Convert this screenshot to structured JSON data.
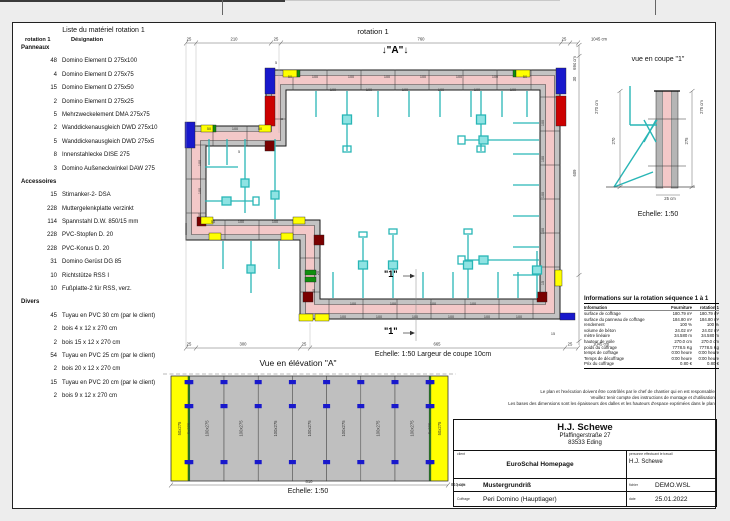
{
  "sheet": {
    "material_list": {
      "title": "Liste du matériel  rotation 1",
      "header": {
        "col1": "rotation 1",
        "col2": "Désignation"
      },
      "sections": [
        {
          "name": "Panneaux",
          "items": [
            {
              "qty": "48",
              "label": "Domino Element D 275x100"
            },
            {
              "qty": "4",
              "label": "Domino Element D 275x75"
            },
            {
              "qty": "15",
              "label": "Domino Element D 275x50"
            },
            {
              "qty": "2",
              "label": "Domino Element D 275x25"
            },
            {
              "qty": "5",
              "label": "Mehrzweckelement DMA 275x75"
            },
            {
              "qty": "2",
              "label": "Wanddickenausgleich DWD 275x10"
            },
            {
              "qty": "5",
              "label": "Wanddickenausgleich DWD 275x5"
            },
            {
              "qty": "8",
              "label": "Innenstahlecke DISE 275"
            },
            {
              "qty": "3",
              "label": "Domino Außeneckwinkel DAW 275"
            }
          ]
        },
        {
          "name": "Accessoires",
          "items": [
            {
              "qty": "15",
              "label": "Stirnanker-2- DSA"
            },
            {
              "qty": "228",
              "label": "Muttergelenkplatte verzinkt"
            },
            {
              "qty": "114",
              "label": "Spannstahl D.W. 850/15 mm"
            },
            {
              "qty": "228",
              "label": "PVC-Stopfen D. 20"
            },
            {
              "qty": "228",
              "label": "PVC-Konus D. 20"
            },
            {
              "qty": "31",
              "label": "Domino Gerüst DG 85"
            },
            {
              "qty": "10",
              "label": "Richtstütze RSS I"
            },
            {
              "qty": "10",
              "label": "Fußplatte-2 für RSS, verz."
            }
          ]
        },
        {
          "name": "Divers",
          "items": [
            {
              "qty": "45",
              "label": "Tuyau en PVC 30 cm (par le client)"
            },
            {
              "qty": "2",
              "label": "bois 4 x 12 x 270 cm"
            },
            {
              "qty": "2",
              "label": "bois 15 x 12 x 270 cm"
            },
            {
              "qty": "54",
              "label": "Tuyau en PVC 25 cm (par le client)"
            },
            {
              "qty": "2",
              "label": "bois 20 x 12 x 270 cm"
            },
            {
              "qty": "15",
              "label": "Tuyau en PVC 20 cm (par le client)"
            },
            {
              "qty": "2",
              "label": "bois 9 x 12 x 270 cm"
            }
          ]
        }
      ]
    },
    "plan": {
      "title": "rotation 1",
      "section_mark_a": "↓\"A\"↓",
      "section_mark_1": "\"1\"",
      "scale_note": "Echelle: 1:50   Largeur de coupe 10cm",
      "dims_top": [
        {
          "t": "25",
          "x": 176
        },
        {
          "t": "210",
          "x": 221
        },
        {
          "t": "25",
          "x": 263
        },
        {
          "t": "760",
          "x": 408
        },
        {
          "t": "25",
          "x": 551
        },
        {
          "t": "1045 cm",
          "x": 586
        }
      ],
      "dims_bottom": [
        {
          "t": "25",
          "x": 176
        },
        {
          "t": "300",
          "x": 230
        },
        {
          "t": "25",
          "x": 291
        },
        {
          "t": "665",
          "x": 424
        },
        {
          "t": "25",
          "x": 557
        },
        {
          "t": "1045 cm",
          "x": 588
        }
      ],
      "dims_right": [
        {
          "t": "694 cm",
          "y": 40
        },
        {
          "t": "30",
          "y": 56
        },
        {
          "t": "609",
          "y": 150
        }
      ],
      "labels": [
        {
          "t": "50",
          "x": 277,
          "y": 55
        },
        {
          "t": "100",
          "x": 302,
          "y": 55
        },
        {
          "t": "100",
          "x": 338,
          "y": 55
        },
        {
          "t": "100",
          "x": 374,
          "y": 55
        },
        {
          "t": "100",
          "x": 410,
          "y": 55
        },
        {
          "t": "100",
          "x": 446,
          "y": 55
        },
        {
          "t": "100",
          "x": 482,
          "y": 55
        },
        {
          "t": "50",
          "x": 512,
          "y": 55
        },
        {
          "t": "100",
          "x": 320,
          "y": 68
        },
        {
          "t": "100",
          "x": 356,
          "y": 68
        },
        {
          "t": "100",
          "x": 392,
          "y": 68
        },
        {
          "t": "100",
          "x": 428,
          "y": 68
        },
        {
          "t": "100",
          "x": 464,
          "y": 68
        },
        {
          "t": "100",
          "x": 500,
          "y": 68
        },
        {
          "t": "100",
          "x": 531,
          "y": 100,
          "r": -90
        },
        {
          "t": "100",
          "x": 531,
          "y": 136,
          "r": -90
        },
        {
          "t": "100",
          "x": 531,
          "y": 172,
          "r": -90
        },
        {
          "t": "100",
          "x": 531,
          "y": 208,
          "r": -90
        },
        {
          "t": "15",
          "x": 531,
          "y": 260,
          "r": -90
        },
        {
          "t": "100",
          "x": 330,
          "y": 295
        },
        {
          "t": "100",
          "x": 366,
          "y": 295
        },
        {
          "t": "100",
          "x": 402,
          "y": 295
        },
        {
          "t": "100",
          "x": 438,
          "y": 295
        },
        {
          "t": "100",
          "x": 474,
          "y": 295
        },
        {
          "t": "100",
          "x": 506,
          "y": 295
        },
        {
          "t": "100",
          "x": 340,
          "y": 282
        },
        {
          "t": "100",
          "x": 380,
          "y": 282
        },
        {
          "t": "100",
          "x": 420,
          "y": 282
        },
        {
          "t": "100",
          "x": 460,
          "y": 282
        },
        {
          "t": "15",
          "x": 540,
          "y": 312
        },
        {
          "t": "50",
          "x": 196,
          "y": 107
        },
        {
          "t": "100",
          "x": 222,
          "y": 107
        },
        {
          "t": "50",
          "x": 247,
          "y": 107
        },
        {
          "t": "50",
          "x": 200,
          "y": 200
        },
        {
          "t": "100",
          "x": 228,
          "y": 200
        },
        {
          "t": "100",
          "x": 262,
          "y": 200
        },
        {
          "t": "100",
          "x": 188,
          "y": 140,
          "r": -90
        },
        {
          "t": "100",
          "x": 188,
          "y": 168,
          "r": -90
        },
        {
          "t": "50",
          "x": 188,
          "y": 192,
          "r": -90
        },
        {
          "t": "5",
          "x": 263,
          "y": 41
        },
        {
          "t": "5",
          "x": 226,
          "y": 130
        },
        {
          "t": "8",
          "x": 270,
          "y": 96,
          "r": -90
        },
        {
          "t": "20",
          "x": 306,
          "y": 250,
          "r": -90
        },
        {
          "t": "30",
          "x": 302,
          "y": 268,
          "r": -90
        }
      ]
    },
    "coupe": {
      "title": "vue en coupe \"1\"",
      "scale": "Echelle: 1:50",
      "labels": [
        {
          "t": "270 cm",
          "x": 585,
          "y": 84,
          "r": -90
        },
        {
          "t": "270",
          "x": 602,
          "y": 118,
          "r": -90
        },
        {
          "t": "275 cm",
          "x": 690,
          "y": 84,
          "r": -90
        },
        {
          "t": "275",
          "x": 675,
          "y": 118,
          "r": -90
        },
        {
          "t": "25 cm",
          "x": 657,
          "y": 177
        }
      ]
    },
    "info_table": {
      "title": "Informations sur la rotation  séquence 1 à 1",
      "columns": [
        "Information",
        "Fourniture",
        "rotation 1"
      ],
      "rows": [
        [
          "surface de coffrage",
          "180.79 m²",
          "180.79 m²"
        ],
        [
          "surface du panneau de coffrage",
          "184.80 m²",
          "184.80 m²"
        ],
        [
          "rendement",
          "100 %",
          "100 %"
        ],
        [
          "volume de béton",
          "24.02 m³",
          "24.02 m³"
        ],
        [
          "mètre linéaire",
          "34.580 m",
          "34.580 m"
        ],
        [
          "hauteur de voile",
          "270.0 cm",
          "270.0 cm"
        ],
        [
          "poids du coffrage",
          "7778.5 Kg",
          "7778.5 Kg"
        ],
        [
          "temps de coffrage",
          "0:00 heure",
          "0:00 heure"
        ],
        [
          "Temps de décoffrage",
          "0:00 heure",
          "0:00 heure"
        ],
        [
          "Prix du coffrage",
          "0.80 €",
          "0.80 €"
        ]
      ]
    },
    "disclaimer": [
      "Le plan et l'exécution doivent être contrôlés par le chef de chantier qui en est responsable!",
      "Veuillez tenir compte des instructions de montage et d'utilisation!",
      "Les bases des dimensions sont les épaisseurs des dalles et les hauteurs d'espace exprimées dans le plan."
    ],
    "elevation": {
      "title": "Vue en élévation \"A\"",
      "scale": "Echelle: 1:50",
      "dim_center": "810",
      "dim_total": "810 cm",
      "panels": [
        {
          "label": "50x275",
          "type": "yellow",
          "w": 50
        },
        {
          "label": "5x275",
          "type": "green",
          "w": 5
        },
        {
          "label": "100x275",
          "type": "gray",
          "w": 100
        },
        {
          "label": "100x275",
          "type": "gray",
          "w": 100
        },
        {
          "label": "100x275",
          "type": "gray",
          "w": 100
        },
        {
          "label": "100x275",
          "type": "gray",
          "w": 100
        },
        {
          "label": "100x275",
          "type": "gray",
          "w": 100
        },
        {
          "label": "100x275",
          "type": "gray",
          "w": 100
        },
        {
          "label": "100x275",
          "type": "gray",
          "w": 100
        },
        {
          "label": "5x275",
          "type": "green",
          "w": 5
        },
        {
          "label": "50x275",
          "type": "yellow",
          "w": 50
        }
      ]
    },
    "title_block": {
      "company": "H.J. Schewe",
      "address1": "Pfaffingerstraße 27",
      "address2": "83533 Eding",
      "client_label": "client",
      "client": "EuroSchal Homepage",
      "worker_label": "personne effectuant le travail",
      "worker": "H.J. Schewe",
      "project_label": "projet",
      "project": "Mustergrundriß",
      "file_label": "fichier",
      "file": "DEMO.WSL",
      "formwork_label": "Coffrage",
      "formwork": "Peri Domino (Hauptlager)",
      "date_label": "date",
      "date": "25.01.2022"
    },
    "colors": {
      "wall_core": "#f3c8c8",
      "formwork_gray": "#c3c3c3",
      "panel_yellow": "#ffff00",
      "panel_green": "#0f8f0f",
      "corner_blue": "#1818cc",
      "corner_red": "#cc0000",
      "corner_dark_red": "#7a0000",
      "brace_teal": "#29b6b6"
    }
  }
}
